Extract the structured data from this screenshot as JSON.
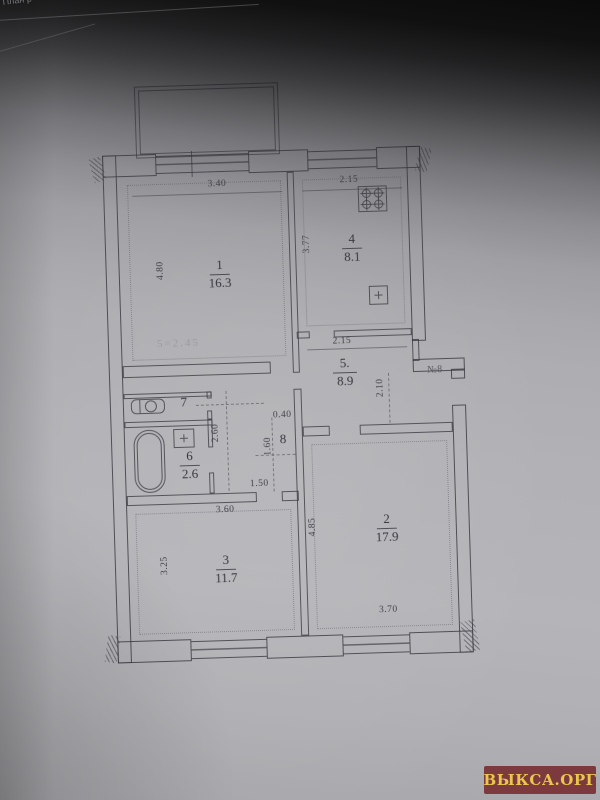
{
  "page": {
    "header_partial": "План р",
    "watermark_text": "ВЫКСА.ОРГ"
  },
  "plan": {
    "entrance_label": "№8",
    "ghost_note": "5=2.45",
    "rooms": {
      "r1": {
        "num": "1",
        "area": "16.3"
      },
      "r2": {
        "num": "2",
        "area": "17.9"
      },
      "r3": {
        "num": "3",
        "area": "11.7"
      },
      "r4": {
        "num": "4",
        "area": "8.1"
      },
      "r5": {
        "num": "5.",
        "area": "8.9"
      },
      "r6": {
        "num": "6",
        "area": "2.6"
      },
      "r7": {
        "num": "7"
      },
      "r8": {
        "num": "8"
      }
    },
    "dims": {
      "r1_width": "3.40",
      "r1_height": "4.80",
      "r4_width": "2.15",
      "r4_height": "3.77",
      "r4_bottom": "2.15",
      "r5_height": "2.10",
      "corridor_height": "2.60",
      "corridor_width": "1.50",
      "r8_width": "0.40",
      "r8_height": "1.60",
      "r3_width": "3.60",
      "r3_height": "3.25",
      "r2_height": "4.85",
      "r2_width": "3.70"
    },
    "icons": {
      "stove": "stove-icon",
      "kitchen_sink": "kitchen-sink-icon",
      "toilet": "toilet-icon",
      "bathtub": "bathtub-icon",
      "washbasin": "washbasin-icon"
    }
  }
}
